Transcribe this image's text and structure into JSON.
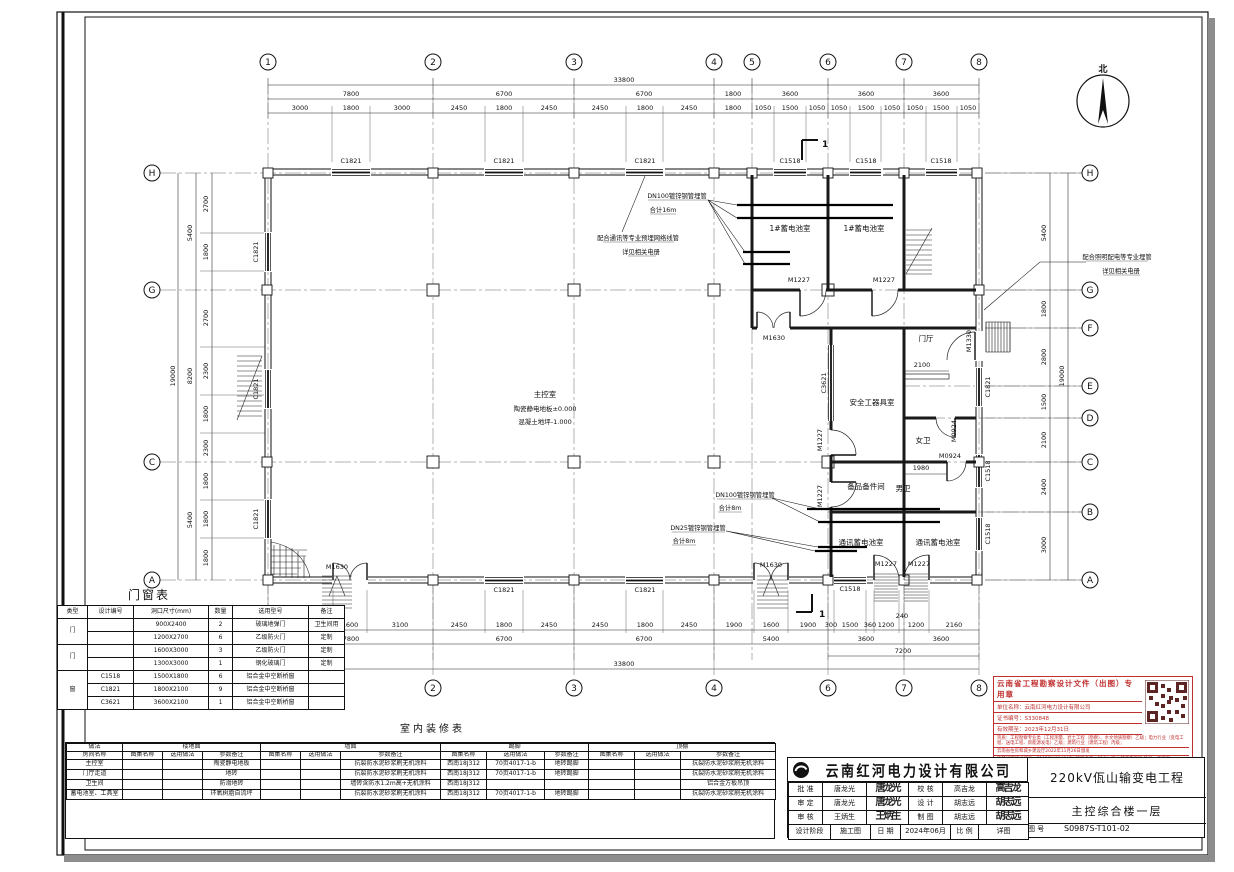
{
  "page": {
    "north": "北",
    "section_mark": "1"
  },
  "plan": {
    "grid_top": [
      "1",
      "2",
      "3",
      "4",
      "5",
      "6",
      "7",
      "8"
    ],
    "grid_bottom": [
      "1",
      "2",
      "3",
      "4",
      "6",
      "7",
      "8"
    ],
    "grid_left": [
      "H",
      "G",
      "C",
      "A"
    ],
    "grid_right": [
      "H",
      "G",
      "F",
      "E",
      "D",
      "C",
      "B",
      "A"
    ],
    "dim_total_top": "33800",
    "dim_top2": [
      "7800",
      "6700",
      "6700",
      "1800",
      "3600",
      "3600",
      "3600"
    ],
    "dim_top3": [
      "3000",
      "1800",
      "3000",
      "2450",
      "1800",
      "2450",
      "2450",
      "1800",
      "2450",
      "1800",
      "1050",
      "1500",
      "1050",
      "1050",
      "1500",
      "1050",
      "1050",
      "1500",
      "1050"
    ],
    "dim_bot3": [
      "3100",
      "1600",
      "3100",
      "2450",
      "1800",
      "2450",
      "2450",
      "1800",
      "2450",
      "1900",
      "1600",
      "1900",
      "300",
      "1500",
      "360",
      "1200",
      "240",
      "1200",
      "2160"
    ],
    "dim_bot2": [
      "7800",
      "6700",
      "6700",
      "5400",
      "3600",
      "3600"
    ],
    "dim_bot_7200": "7200",
    "dim_total_bot": "33800",
    "dim_left_seg": [
      "2700",
      "1800",
      "2700",
      "2300",
      "1800",
      "2300",
      "1800",
      "1800",
      "1800"
    ],
    "dim_left_grp": [
      "5400",
      "8200",
      "5400"
    ],
    "dim_left_total": "19000",
    "dim_right_seg": [
      "5400",
      "1800",
      "2800",
      "1500",
      "2100",
      "2400",
      "3000"
    ],
    "dim_right_total": "19000",
    "windows": {
      "c1821": "C1821",
      "c1518": "C1518",
      "c3621": "C3621"
    },
    "doors": {
      "m1630": "M1630",
      "m1227": "M1227",
      "m1330": "M1330",
      "m0924": "M0924"
    },
    "rooms": {
      "main": "主控室",
      "battery1": "1#蓄电池室",
      "lobby": "门厅",
      "safety": "安全工器具室",
      "wc_f": "女卫",
      "wc_m": "男卫",
      "spare": "备品备件间",
      "comm_battery": "通讯蓄电池室"
    },
    "levels": {
      "floor": "陶瓷静电地板±0.000",
      "concrete": "混凝土地坪-1.000"
    },
    "inner_dims": {
      "d2100": "2100",
      "d1980": "1980",
      "d240": "240"
    },
    "ann": {
      "a1_1": "DN100镀锌钢管埋管",
      "a1_2": "合计16m",
      "a2_1": "配合通讯等专业预埋网络线管",
      "a2_2": "详见相关电册",
      "a3_1": "配合照明配电等专业埋管",
      "a3_2": "详见相关电册",
      "a4_1": "DN100镀锌钢管埋管",
      "a4_2": "合计8m",
      "a5_1": "DN25镀锌钢管埋管",
      "a5_2": "合计8m"
    }
  },
  "door_window_table": {
    "title": "门窗表",
    "headers": [
      "类型",
      "设计编号",
      "洞口尺寸(mm)",
      "数量",
      "选用型号",
      "备注"
    ],
    "cat_door": "门",
    "cat_win": "窗",
    "rows": [
      {
        "code": "",
        "size": "900X2400",
        "qty": "2",
        "model": "玻璃地弹门",
        "note": "卫生间用"
      },
      {
        "code": "",
        "size": "1200X2700",
        "qty": "6",
        "model": "乙级防火门",
        "note": "定制"
      },
      {
        "code": "",
        "size": "1600X3000",
        "qty": "3",
        "model": "乙级防火门",
        "note": "定制"
      },
      {
        "code": "",
        "size": "1300X3000",
        "qty": "1",
        "model": "钢化玻璃门",
        "note": "定制"
      },
      {
        "code": "C1518",
        "size": "1500X1800",
        "qty": "6",
        "model": "铝合金中空断桥窗",
        "note": ""
      },
      {
        "code": "C1821",
        "size": "1800X2100",
        "qty": "9",
        "model": "铝合金中空断桥窗",
        "note": ""
      },
      {
        "code": "C3621",
        "size": "3600X2100",
        "qty": "1",
        "model": "铝合金中空断桥窗",
        "note": ""
      }
    ]
  },
  "finish_table": {
    "title": "室内装修表",
    "col1_top": "做法",
    "col1_bottom": "房间名称",
    "groups": [
      "楼地面",
      "墙面",
      "踢脚",
      "顶棚"
    ],
    "sub": [
      "图集名称",
      "选用做法",
      "参数备注"
    ],
    "rows": [
      {
        "room": "主控室",
        "floor": "陶瓷静电地板",
        "wall": "抗裂防水泥砂浆刷无机涂料",
        "skirt_atlas": "西南18J312",
        "skirt_method": "70页4017-1-b",
        "skirt_note": "地砖踢脚",
        "ceiling": "抗裂防水泥砂浆刷无机涂料"
      },
      {
        "room": "门厅走道",
        "floor": "地砖",
        "wall": "抗裂防水泥砂浆刷无机涂料",
        "skirt_atlas": "西南18J312",
        "skirt_method": "70页4017-1-b",
        "skirt_note": "地砖踢脚",
        "ceiling": "抗裂防水泥砂浆刷无机涂料"
      },
      {
        "room": "卫生间",
        "floor": "防滑地砖",
        "wall": "墙砖含防水1.2m高+无机涂料",
        "skirt_atlas": "西南18J312",
        "skirt_method": "",
        "skirt_note": "",
        "ceiling": "铝合金方板吊顶"
      },
      {
        "room": "蓄电池室、工具室",
        "floor": "环氧树脂自流坪",
        "wall": "抗裂防水泥砂浆刷无机涂料",
        "skirt_atlas": "西南18J312",
        "skirt_method": "70页4017-1-b",
        "skirt_note": "地砖踢脚",
        "ceiling": "抗裂防水泥砂浆刷无机涂料"
      }
    ]
  },
  "title_block": {
    "company": "云南红河电力设计有限公司",
    "project": "220kV佤山输变电工程",
    "drawing": "主控综合楼一层",
    "rows": [
      {
        "l1": "批 准",
        "v1": "唐龙光",
        "s1": "唐龙光",
        "l2": "校 核",
        "v2": "高吉龙",
        "s2": "高吉龙"
      },
      {
        "l1": "审 定",
        "v1": "唐龙光",
        "s1": "唐龙光",
        "l2": "设 计",
        "v2": "胡志远",
        "s2": "胡志远"
      },
      {
        "l1": "审 核",
        "v1": "王炳生",
        "s1": "王炳生",
        "l2": "制 图",
        "v2": "胡志远",
        "s2": "胡志远"
      }
    ],
    "bottom": {
      "stage_label": "设计阶段",
      "stage": "施工图",
      "date_label": "日 期",
      "date": "2024年06月",
      "scale_label": "比 例",
      "detail_label": "详图",
      "no_label": "图 号",
      "no": "S0987S-T101-02"
    }
  },
  "stamp": {
    "title": "云南省工程勘察设计文件（出图）专用章",
    "l1": "单位名称：云南红河电力设计有限公司",
    "l2": "证书编号：S330848",
    "l3": "有效期至：2023年12月31日",
    "l4": "资质：工程勘察专业类（工程测量、岩土工程（勘察）、水文地质勘察）乙级；电力行业（变电工程、送电工程、新能源发电）乙级；建筑行业（建筑工程）丙级；",
    "l5": "云南省住房和城乡建设厅2022年11月26日颁发",
    "l6": "项目经理证书编号：22023W004847Y 项目名称：220kV佤山输变电工程  阶段：施工图"
  }
}
